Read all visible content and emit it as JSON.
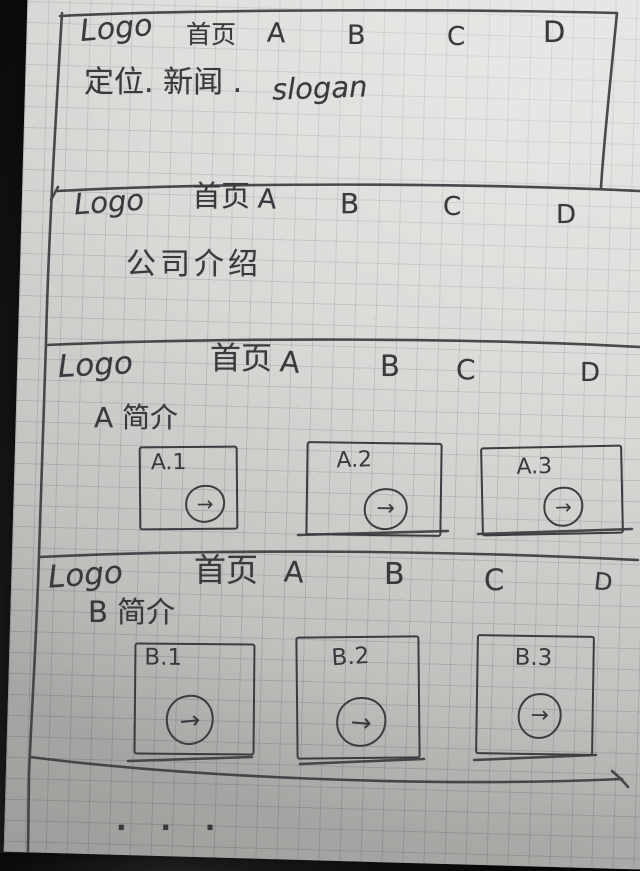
{
  "icons": {
    "arrow": "→"
  },
  "colors": {
    "ink": "#3a393d",
    "paper": "#d8d7d4",
    "desk": "#0e0e0f"
  },
  "footer": {
    "ellipsis": "· · ·"
  },
  "sections": [
    {
      "name": "home",
      "logo": "Logo",
      "nav": [
        "首页",
        "A",
        "B",
        "C",
        "D"
      ],
      "tagline_cn": "定位. 新闻 .",
      "tagline_en": "slogan"
    },
    {
      "name": "company",
      "logo": "Logo",
      "nav": [
        "首页",
        "A",
        "B",
        "C",
        "D"
      ],
      "body": "公司介绍"
    },
    {
      "name": "product-a",
      "logo": "Logo",
      "nav": [
        "首页",
        "A",
        "B",
        "C",
        "D"
      ],
      "heading": "A 简介",
      "cards": [
        {
          "label": "A.1"
        },
        {
          "label": "A.2"
        },
        {
          "label": "A.3"
        }
      ]
    },
    {
      "name": "product-b",
      "logo": "Logo",
      "nav": [
        "首页",
        "A",
        "B",
        "C",
        "D"
      ],
      "heading": "B 简介",
      "cards": [
        {
          "label": "B.1"
        },
        {
          "label": "B.2"
        },
        {
          "label": "B.3"
        }
      ]
    }
  ]
}
